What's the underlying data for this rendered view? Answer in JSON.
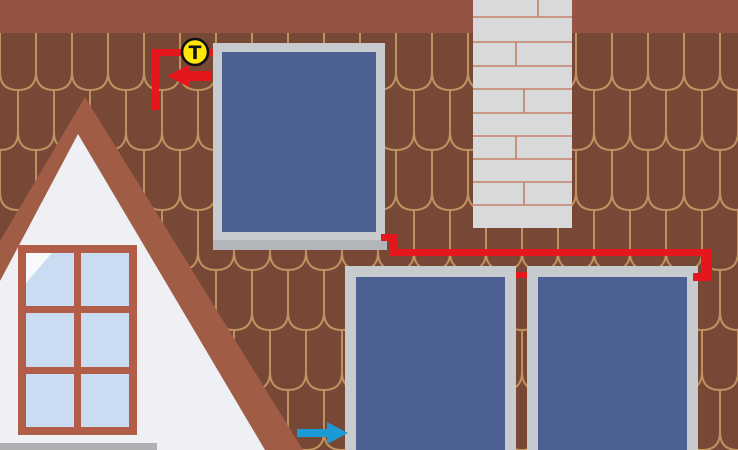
{
  "sensor": {
    "label": "T"
  },
  "icons": {
    "temperature_sensor": "circled-T-badge",
    "hot_flow": "arrow-left-red",
    "cold_flow": "arrow-right-blue"
  },
  "colors": {
    "roof_base": "#764835",
    "tile_line": "#bf9060",
    "ridge_band": "#935443",
    "gable_band": "#a15c46",
    "gable_wall": "#eef0f3",
    "sill_gray": "#aeb0b2",
    "window_frame": "#b25d48",
    "window_pane": "#c9dcf1",
    "pane_shine": "#f7f9fb",
    "chimney": "#d8d9da",
    "chimney_mortar": "#c5806a",
    "panel_frame": "#c7cbce",
    "panel_rail": "#b2b6b8",
    "panel_glass": "#4c6191",
    "pipe_red": "#e5171c",
    "arrow_blue": "#1b9ad6",
    "sensor_yellow": "#ffe508",
    "sensor_outline": "#111111"
  }
}
